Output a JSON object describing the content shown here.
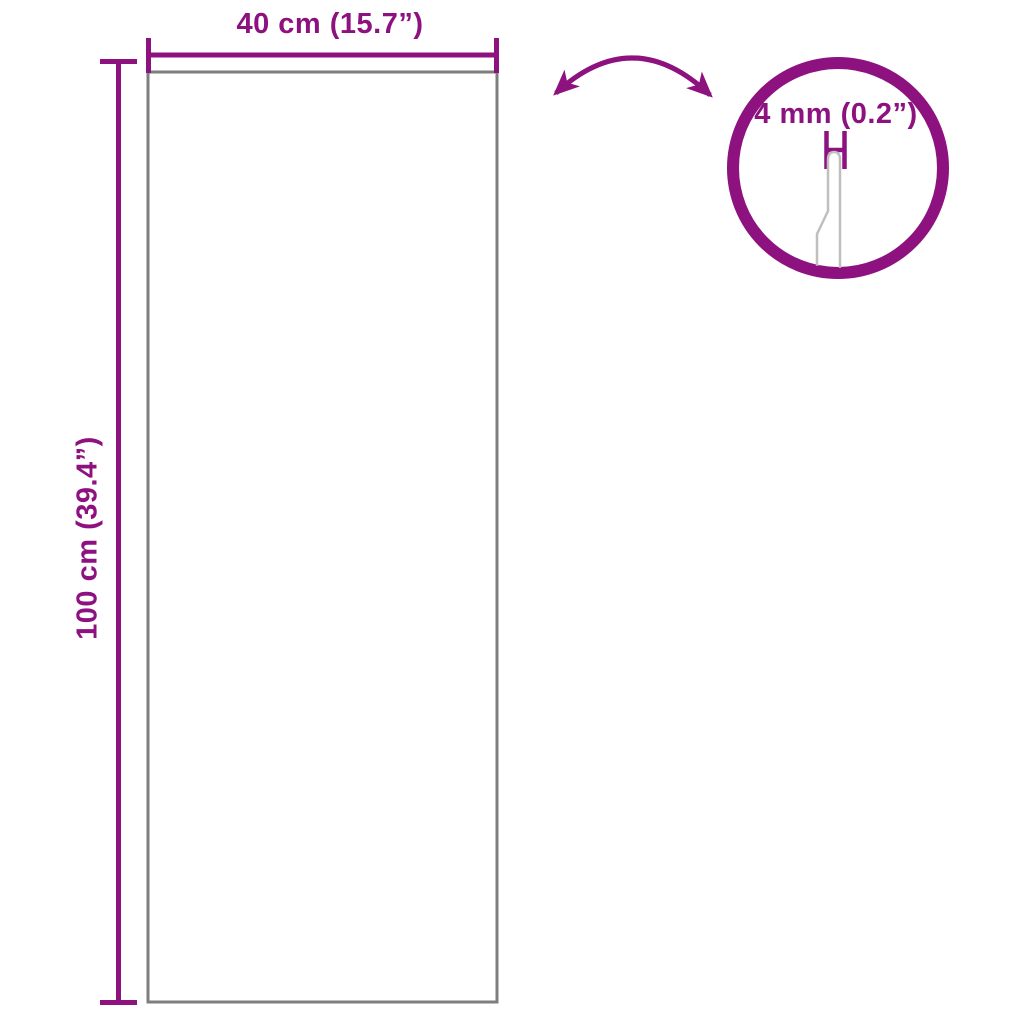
{
  "colors": {
    "accent": "#8D1280",
    "outline": "#7E7E7E",
    "profile": "#BFBFBF",
    "background": "#FFFFFF"
  },
  "labels": {
    "width": "40 cm (15.7”)",
    "height": "100 cm (39.4”)",
    "thickness": "4 mm (0.2”)"
  }
}
